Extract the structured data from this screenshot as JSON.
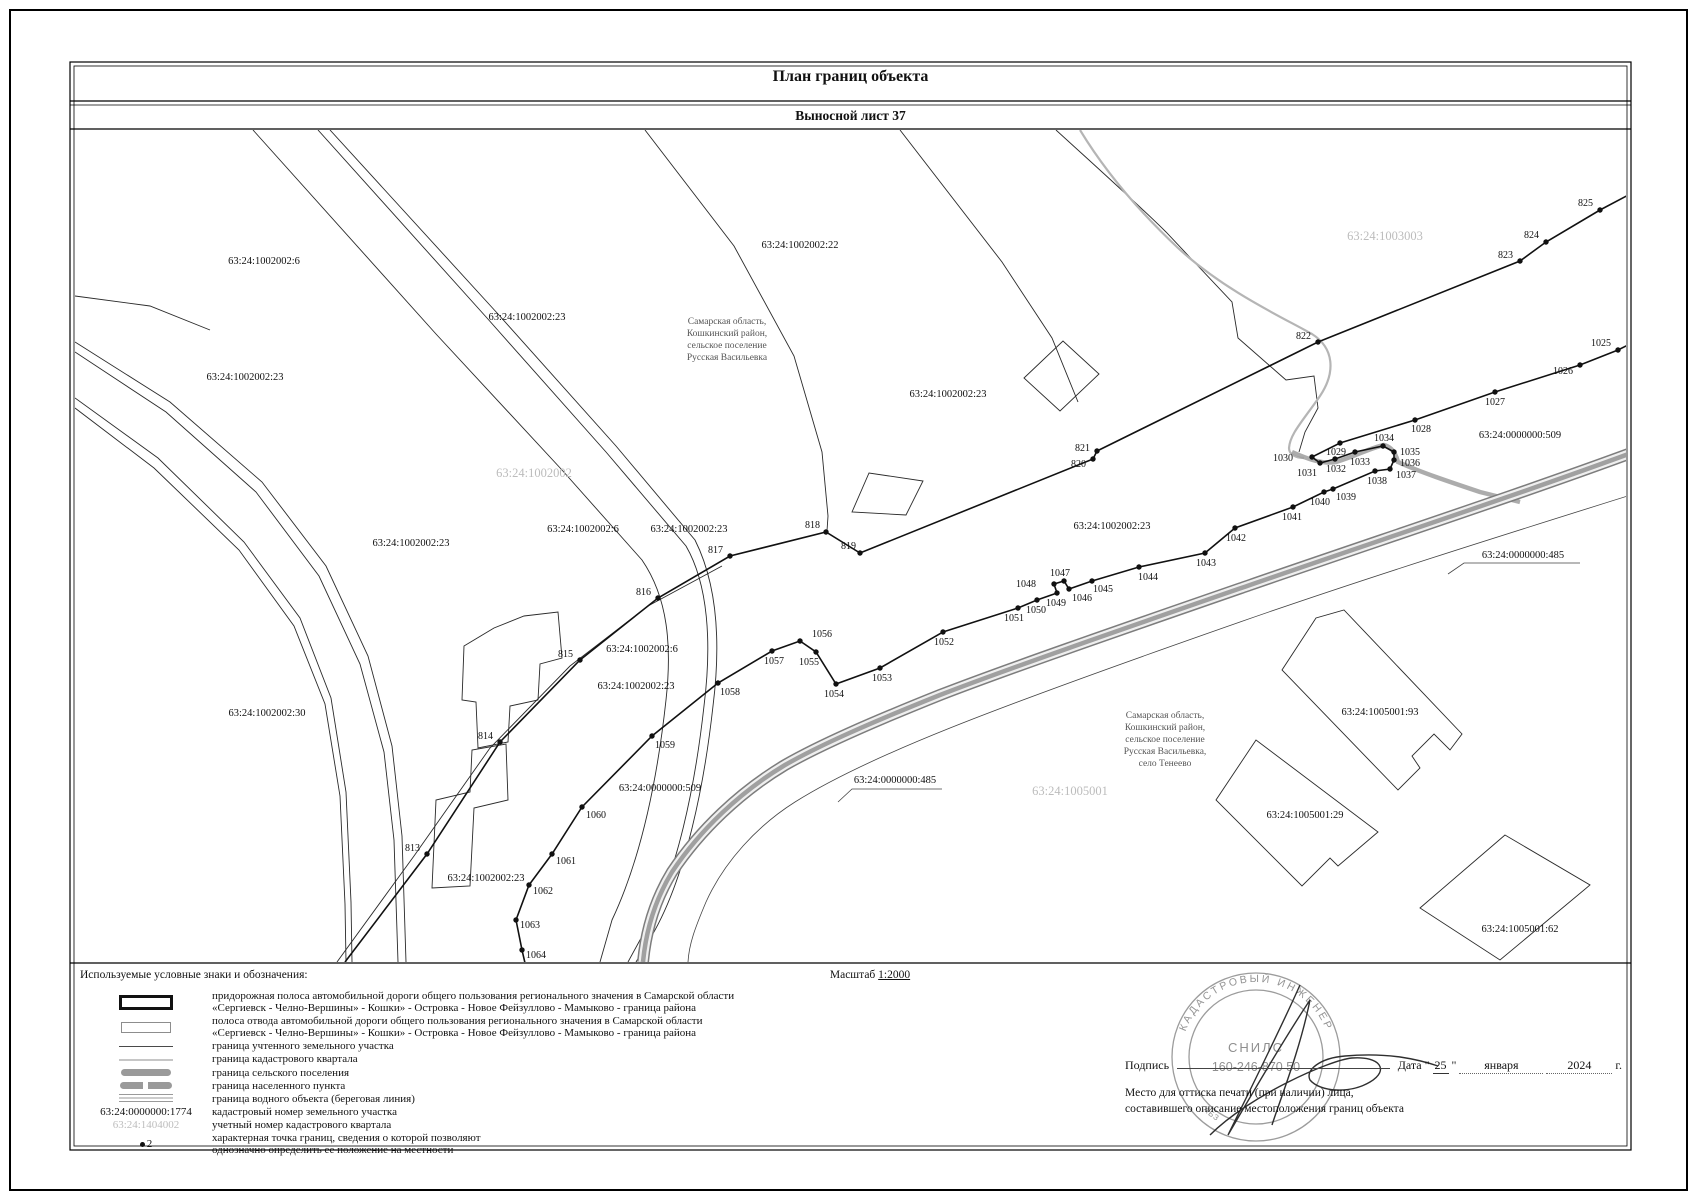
{
  "page": {
    "title": "План границ объекта",
    "subtitle": "Выносной лист 37"
  },
  "colors": {
    "ink": "#111111",
    "quarter_line_gray": "#b5b5b5",
    "band_gray": "#9e9e9e",
    "quarter_label_gray": "#bcbcbc",
    "stamp_gray": "#949494"
  },
  "map": {
    "region_notes": [
      {
        "x": 727,
        "y": 324,
        "lines": [
          "Самарская область,",
          "Кошкинский район,",
          "сельское поселение",
          "Русская Васильевка"
        ]
      },
      {
        "x": 1165,
        "y": 718,
        "lines": [
          "Самарская область,",
          "Кошкинский район,",
          "сельское поселение",
          "Русская Васильевка,",
          "село Тенеево"
        ]
      }
    ],
    "quarter_labels": [
      {
        "text": "63:24:1002002",
        "x": 534,
        "y": 477
      },
      {
        "text": "63:24:1003003",
        "x": 1385,
        "y": 240
      },
      {
        "text": "63:24:1005001",
        "x": 1070,
        "y": 795
      }
    ],
    "parcel_labels": [
      {
        "text": "63:24:1002002:6",
        "x": 264,
        "y": 264
      },
      {
        "text": "63:24:1002002:22",
        "x": 800,
        "y": 248
      },
      {
        "text": "63:24:1002002:23",
        "x": 527,
        "y": 320
      },
      {
        "text": "63:24:1002002:23",
        "x": 245,
        "y": 380
      },
      {
        "text": "63:24:1002002:23",
        "x": 948,
        "y": 397
      },
      {
        "text": "63:24:0000000:509",
        "x": 1520,
        "y": 438
      },
      {
        "text": "63:24:1002002:23",
        "x": 1112,
        "y": 529
      },
      {
        "text": "63:24:0000000:485",
        "x": 1523,
        "y": 558
      },
      {
        "text": "63:24:1002002:6",
        "x": 583,
        "y": 532
      },
      {
        "text": "63:24:1002002:23",
        "x": 689,
        "y": 532
      },
      {
        "text": "63:24:1002002:23",
        "x": 411,
        "y": 546
      },
      {
        "text": "63:24:1002002:6",
        "x": 642,
        "y": 652
      },
      {
        "text": "63:24:1002002:23",
        "x": 636,
        "y": 689
      },
      {
        "text": "63:24:1002002:30",
        "x": 267,
        "y": 716
      },
      {
        "text": "63:24:0000000:509",
        "x": 660,
        "y": 791
      },
      {
        "text": "63:24:0000000:485",
        "x": 895,
        "y": 783
      },
      {
        "text": "63:24:1005001:93",
        "x": 1380,
        "y": 715
      },
      {
        "text": "63:24:1005001:29",
        "x": 1305,
        "y": 818
      },
      {
        "text": "63:24:1005001:62",
        "x": 1520,
        "y": 932
      },
      {
        "text": "63:24:1002002:23",
        "x": 486,
        "y": 881
      }
    ],
    "points": [
      {
        "n": "813",
        "x": 427,
        "y": 854,
        "lx": 420,
        "ly": 851,
        "a": "e"
      },
      {
        "n": "814",
        "x": 500,
        "y": 742,
        "lx": 493,
        "ly": 739,
        "a": "e"
      },
      {
        "n": "815",
        "x": 580,
        "y": 660,
        "lx": 573,
        "ly": 657,
        "a": "e"
      },
      {
        "n": "816",
        "x": 658,
        "y": 598,
        "lx": 651,
        "ly": 595,
        "a": "e"
      },
      {
        "n": "817",
        "x": 730,
        "y": 556,
        "lx": 723,
        "ly": 553,
        "a": "e"
      },
      {
        "n": "818",
        "x": 826,
        "y": 532,
        "lx": 820,
        "ly": 528,
        "a": "e"
      },
      {
        "n": "819",
        "x": 860,
        "y": 553,
        "lx": 856,
        "ly": 549,
        "a": "e"
      },
      {
        "n": "820",
        "x": 1093,
        "y": 459,
        "lx": 1086,
        "ly": 467,
        "a": "e"
      },
      {
        "n": "821",
        "x": 1097,
        "y": 451,
        "lx": 1090,
        "ly": 451,
        "a": "e"
      },
      {
        "n": "822",
        "x": 1318,
        "y": 342,
        "lx": 1311,
        "ly": 339,
        "a": "e"
      },
      {
        "n": "823",
        "x": 1520,
        "y": 261,
        "lx": 1513,
        "ly": 258,
        "a": "e"
      },
      {
        "n": "824",
        "x": 1546,
        "y": 242,
        "lx": 1539,
        "ly": 238,
        "a": "e"
      },
      {
        "n": "825",
        "x": 1600,
        "y": 210,
        "lx": 1593,
        "ly": 206,
        "a": "e"
      },
      {
        "n": "1025",
        "x": 1618,
        "y": 350,
        "lx": 1611,
        "ly": 346,
        "a": "e"
      },
      {
        "n": "1026",
        "x": 1580,
        "y": 365,
        "lx": 1573,
        "ly": 374,
        "a": "e"
      },
      {
        "n": "1027",
        "x": 1495,
        "y": 392,
        "lx": 1495,
        "ly": 405,
        "a": "m"
      },
      {
        "n": "1028",
        "x": 1415,
        "y": 420,
        "lx": 1421,
        "ly": 432,
        "a": "m"
      },
      {
        "n": "1029",
        "x": 1340,
        "y": 443,
        "lx": 1336,
        "ly": 455,
        "a": "m"
      },
      {
        "n": "1030",
        "x": 1312,
        "y": 457,
        "lx": 1293,
        "ly": 461,
        "a": "e"
      },
      {
        "n": "1031",
        "x": 1320,
        "y": 463,
        "lx": 1307,
        "ly": 476,
        "a": "m"
      },
      {
        "n": "1032",
        "x": 1335,
        "y": 459,
        "lx": 1336,
        "ly": 472,
        "a": "m"
      },
      {
        "n": "1033",
        "x": 1355,
        "y": 452,
        "lx": 1360,
        "ly": 465,
        "a": "m"
      },
      {
        "n": "1034",
        "x": 1383,
        "y": 446,
        "lx": 1384,
        "ly": 441,
        "a": "m"
      },
      {
        "n": "1035",
        "x": 1394,
        "y": 452,
        "lx": 1400,
        "ly": 455,
        "a": "s"
      },
      {
        "n": "1036",
        "x": 1394,
        "y": 460,
        "lx": 1400,
        "ly": 466,
        "a": "s"
      },
      {
        "n": "1037",
        "x": 1390,
        "y": 469,
        "lx": 1396,
        "ly": 478,
        "a": "s"
      },
      {
        "n": "1038",
        "x": 1375,
        "y": 471,
        "lx": 1377,
        "ly": 484,
        "a": "m"
      },
      {
        "n": "1039",
        "x": 1333,
        "y": 489,
        "lx": 1346,
        "ly": 500,
        "a": "m"
      },
      {
        "n": "1040",
        "x": 1324,
        "y": 492,
        "lx": 1320,
        "ly": 505,
        "a": "m"
      },
      {
        "n": "1041",
        "x": 1293,
        "y": 507,
        "lx": 1292,
        "ly": 520,
        "a": "m"
      },
      {
        "n": "1042",
        "x": 1235,
        "y": 528,
        "lx": 1236,
        "ly": 541,
        "a": "m"
      },
      {
        "n": "1043",
        "x": 1205,
        "y": 553,
        "lx": 1206,
        "ly": 566,
        "a": "m"
      },
      {
        "n": "1044",
        "x": 1139,
        "y": 567,
        "lx": 1148,
        "ly": 580,
        "a": "m"
      },
      {
        "n": "1045",
        "x": 1092,
        "y": 581,
        "lx": 1103,
        "ly": 592,
        "a": "m"
      },
      {
        "n": "1046",
        "x": 1069,
        "y": 589,
        "lx": 1082,
        "ly": 601,
        "a": "m"
      },
      {
        "n": "1047",
        "x": 1064,
        "y": 581,
        "lx": 1060,
        "ly": 576,
        "a": "m"
      },
      {
        "n": "1048",
        "x": 1054,
        "y": 584,
        "lx": 1036,
        "ly": 587,
        "a": "e"
      },
      {
        "n": "1049",
        "x": 1057,
        "y": 593,
        "lx": 1056,
        "ly": 606,
        "a": "m"
      },
      {
        "n": "1050",
        "x": 1037,
        "y": 600,
        "lx": 1036,
        "ly": 613,
        "a": "m"
      },
      {
        "n": "1051",
        "x": 1018,
        "y": 608,
        "lx": 1014,
        "ly": 621,
        "a": "m"
      },
      {
        "n": "1052",
        "x": 943,
        "y": 632,
        "lx": 944,
        "ly": 645,
        "a": "m"
      },
      {
        "n": "1053",
        "x": 880,
        "y": 668,
        "lx": 882,
        "ly": 681,
        "a": "m"
      },
      {
        "n": "1054",
        "x": 836,
        "y": 684,
        "lx": 834,
        "ly": 697,
        "a": "m"
      },
      {
        "n": "1055",
        "x": 816,
        "y": 652,
        "lx": 809,
        "ly": 665,
        "a": "m"
      },
      {
        "n": "1056",
        "x": 800,
        "y": 641,
        "lx": 812,
        "ly": 637,
        "a": "s"
      },
      {
        "n": "1057",
        "x": 772,
        "y": 651,
        "lx": 774,
        "ly": 664,
        "a": "m"
      },
      {
        "n": "1058",
        "x": 718,
        "y": 683,
        "lx": 730,
        "ly": 695,
        "a": "m"
      },
      {
        "n": "1059",
        "x": 652,
        "y": 736,
        "lx": 665,
        "ly": 748,
        "a": "m"
      },
      {
        "n": "1060",
        "x": 582,
        "y": 807,
        "lx": 596,
        "ly": 818,
        "a": "m"
      },
      {
        "n": "1061",
        "x": 552,
        "y": 854,
        "lx": 566,
        "ly": 864,
        "a": "m"
      },
      {
        "n": "1062",
        "x": 529,
        "y": 885,
        "lx": 543,
        "ly": 894,
        "a": "m"
      },
      {
        "n": "1063",
        "x": 516,
        "y": 920,
        "lx": 530,
        "ly": 928,
        "a": "m"
      },
      {
        "n": "1064",
        "x": 522,
        "y": 950,
        "lx": 536,
        "ly": 958,
        "a": "m"
      }
    ]
  },
  "legend": {
    "heading": "Используемые условные знаки и обозначения:",
    "scale_label": "Масштаб",
    "scale_value": "1:2000",
    "items": [
      {
        "symbol_type": "road-strip",
        "lines": [
          "придорожная полоса автомобильной дороги общего пользования регионального значения в Самарской области",
          "«Сергиевск - Челно-Вершины» - Кошки» - Островка - Новое Фейзуллово - Мамыково - граница района"
        ]
      },
      {
        "symbol_type": "allotment-strip",
        "lines": [
          "полоса отвода автомобильной дороги общего пользования регионального значения в Самарской области",
          "«Сергиевск - Челно-Вершины» - Кошки» - Островка - Новое Фейзуллово - Мамыково - граница района"
        ]
      },
      {
        "symbol_type": "thin-dark-line",
        "lines": [
          "граница учтенного земельного участка"
        ]
      },
      {
        "symbol_type": "thin-gray-line",
        "lines": [
          "граница кадастрового квартала"
        ]
      },
      {
        "symbol_type": "thick-gray-line",
        "lines": [
          "граница сельского поселения"
        ]
      },
      {
        "symbol_type": "thick-gray-dashed-line",
        "lines": [
          "граница населенного пункта"
        ]
      },
      {
        "symbol_type": "striped-line",
        "lines": [
          "граница водного объекта (береговая линия)"
        ]
      },
      {
        "symbol_type": "text",
        "symbol_text": "63:24:0000000:1774",
        "lines": [
          "кадастровый номер земельного участка"
        ]
      },
      {
        "symbol_type": "gray-text",
        "symbol_text": "63:24:1404002",
        "lines": [
          "учетный номер кадастрового квартала"
        ]
      },
      {
        "symbol_type": "point",
        "symbol_text": "2",
        "lines": [
          "характерная точка границ, сведения о которой позволяют",
          "однозначно определить ее положение на местности"
        ]
      }
    ]
  },
  "signature_block": {
    "sign_label": "Подпись",
    "date_label": "Дата",
    "quote": "\"",
    "date_day": "25",
    "date_month": "января",
    "date_year": "2024",
    "date_suffix": "г.",
    "note_line1": "Место для оттиска печати (при наличии) лица,",
    "note_line2": "составившего описание местоположения границ объекта"
  },
  "stamp": {
    "ring_text": "КАДАСТРОВЫЙ ИНЖЕНЕР",
    "ring_text2": "АБЗ",
    "center_line1": "СНИЛС",
    "center_line2": "160-246-870 50"
  }
}
